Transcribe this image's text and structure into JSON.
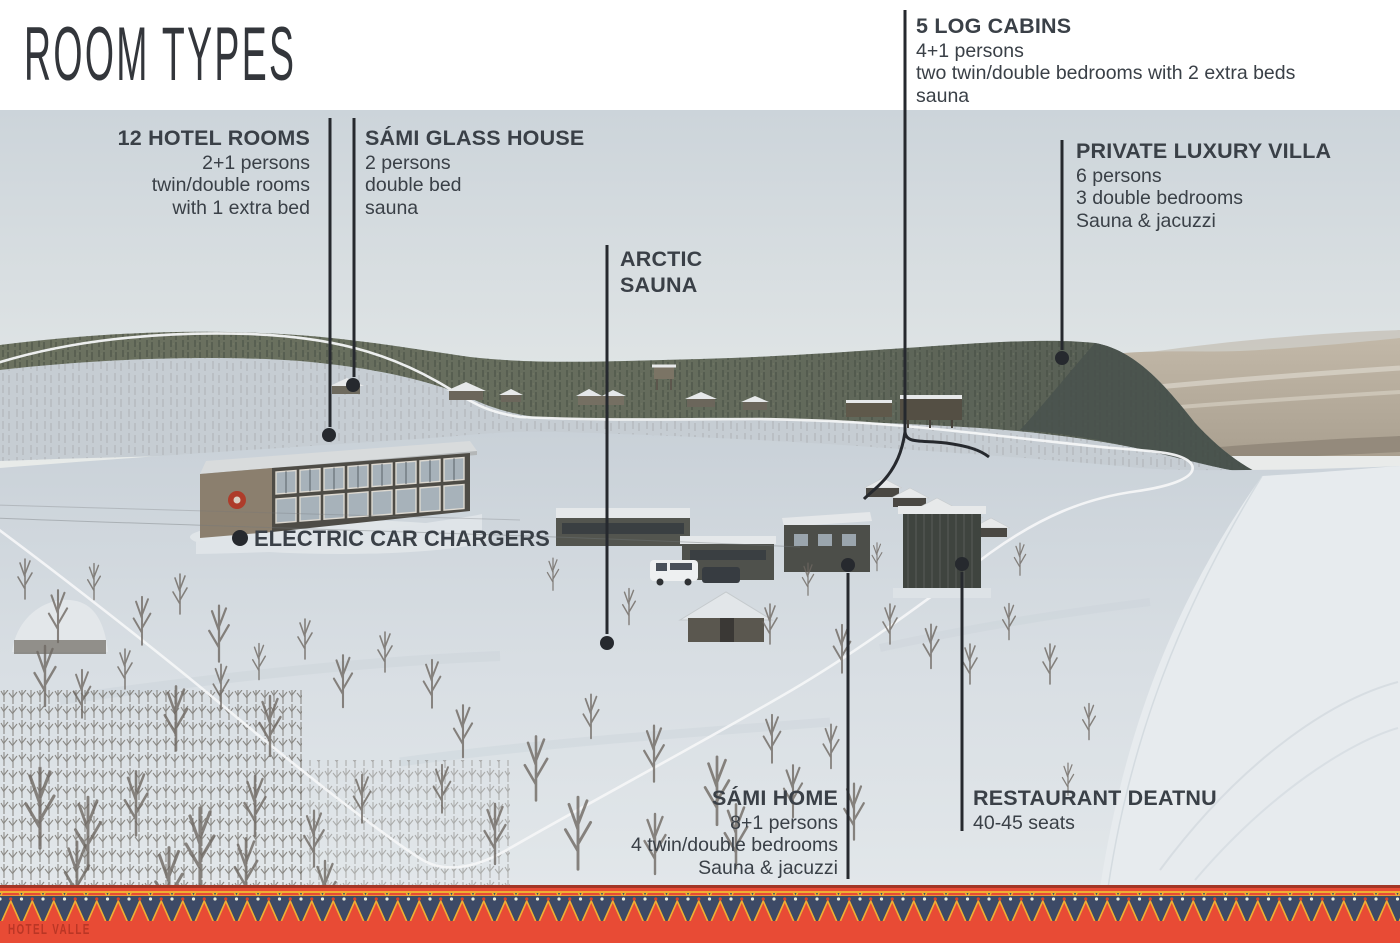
{
  "title": "ROOM TYPES",
  "brand": {
    "name": "HOTEL VALLE"
  },
  "labels": {
    "hotel_rooms": {
      "heading": "12 HOTEL ROOMS",
      "lines": [
        "2+1 persons",
        "twin/double rooms",
        "with 1 extra bed"
      ]
    },
    "glass_house": {
      "heading": "SÁMI GLASS HOUSE",
      "lines": [
        "2 persons",
        "double bed",
        "sauna"
      ]
    },
    "arctic_sauna": {
      "line1": "ARCTIC",
      "line2": "SAUNA"
    },
    "log_cabins": {
      "heading": "5 LOG CABINS",
      "lines": [
        "4+1 persons",
        "two twin/double bedrooms with 2 extra beds",
        "sauna"
      ]
    },
    "villa": {
      "heading": "PRIVATE LUXURY VILLA",
      "lines": [
        "6 persons",
        "3 double bedrooms",
        "Sauna & jacuzzi"
      ]
    },
    "electric": {
      "heading": "ELECTRIC CAR CHARGERS"
    },
    "sami_home": {
      "heading": "SÁMI HOME",
      "lines": [
        "8+1 persons",
        "4 twin/double bedrooms",
        "Sauna & jacuzzi"
      ]
    },
    "restaurant": {
      "heading": "RESTAURANT DEATNU",
      "lines": [
        "40-45 seats"
      ]
    }
  },
  "colors": {
    "accent_red": "#e84b35",
    "border_navy": "#3d4a66",
    "border_gold": "#efae33",
    "label_text": "#3a4047",
    "pointer_line": "#26292e",
    "outline_white": "#f4f6f7"
  }
}
